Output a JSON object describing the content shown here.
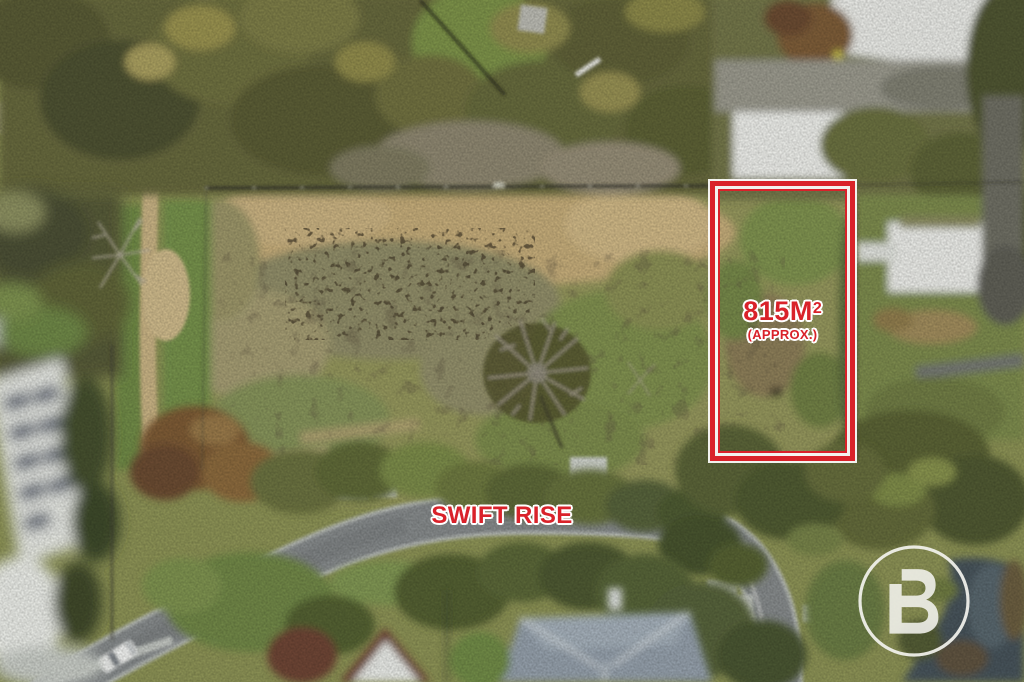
{
  "annotations": {
    "lot": {
      "area_value": "815M",
      "area_superscript": "2",
      "area_note": "(APPROX.)"
    },
    "street": {
      "label": "SWIFT RISE"
    }
  },
  "logo": {
    "letter": "B"
  },
  "colors": {
    "annotation_red": "#d9222a",
    "halo_white": "#ffffff",
    "logo_white": "#f3f3ee"
  }
}
